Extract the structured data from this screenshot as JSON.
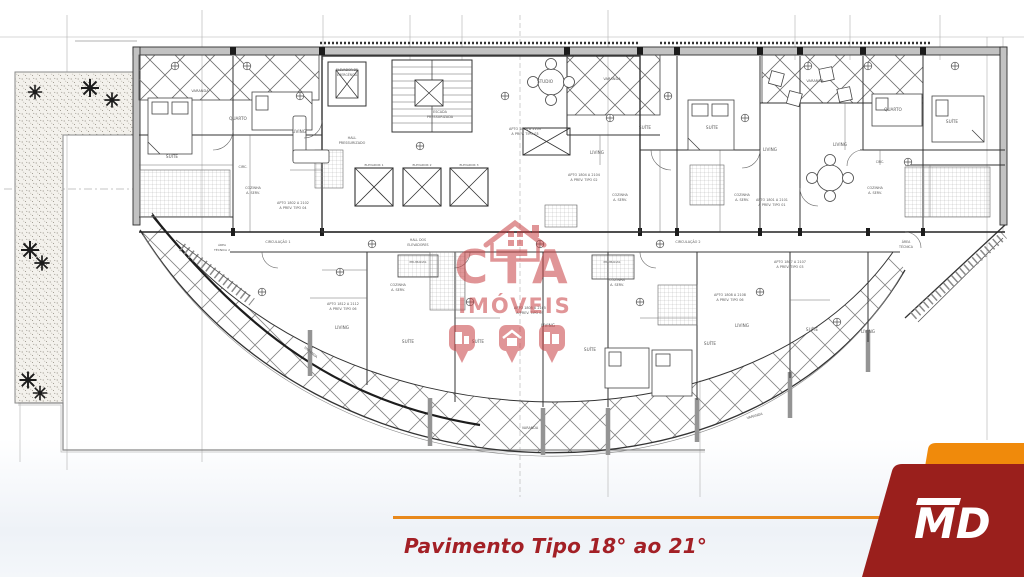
{
  "footer": {
    "caption": "Pavimento Tipo 18° ao 21°",
    "line_color": "#e8891c",
    "text_color": "#a32026"
  },
  "watermark": {
    "line1": "CTA",
    "line2": "IMÓVEIS",
    "color": "#c84043"
  },
  "brand": {
    "logo_text": "MD",
    "orange": "#f08a0b",
    "dark_red": "#9a1f1c"
  },
  "floorplan": {
    "labels": [
      {
        "t": "VARANDA",
        "x": 200,
        "y": 92,
        "s": 3.6
      },
      {
        "t": "SUÍTE",
        "x": 172,
        "y": 158,
        "s": 4.2
      },
      {
        "t": "QUARTO",
        "x": 238,
        "y": 120,
        "s": 4.2
      },
      {
        "t": "LIVING",
        "x": 299,
        "y": 133,
        "s": 4.2
      },
      {
        "t": "CIRC.",
        "x": 243,
        "y": 168,
        "s": 3.4
      },
      {
        "t": "COZINHA",
        "x": 253,
        "y": 189,
        "s": 3.4
      },
      {
        "t": "A. SERV.",
        "x": 253,
        "y": 194,
        "s": 3.4
      },
      {
        "t": "APTO 1802 A 2102",
        "x": 293,
        "y": 204,
        "s": 3.4
      },
      {
        "t": "A PREV. TIPO 04",
        "x": 293,
        "y": 209,
        "s": 3.4
      },
      {
        "t": "ELEVADOR DE",
        "x": 347,
        "y": 71,
        "s": 3.1
      },
      {
        "t": "EMERGÊNCIA",
        "x": 347,
        "y": 76,
        "s": 3.1
      },
      {
        "t": "ESCADA",
        "x": 440,
        "y": 113,
        "s": 3.4
      },
      {
        "t": "PRESSURIZADA",
        "x": 440,
        "y": 118,
        "s": 3.4
      },
      {
        "t": "HALL",
        "x": 352,
        "y": 139,
        "s": 3.4
      },
      {
        "t": "PRESSURIZADO",
        "x": 352,
        "y": 144,
        "s": 3.4
      },
      {
        "t": "ELEVADOR 1",
        "x": 374,
        "y": 166,
        "s": 3
      },
      {
        "t": "ELEVADOR 2",
        "x": 422,
        "y": 166,
        "s": 3
      },
      {
        "t": "ELEVADOR 3",
        "x": 469,
        "y": 166,
        "s": 3
      },
      {
        "t": "STUDIO",
        "x": 545,
        "y": 83,
        "s": 4.2
      },
      {
        "t": "APTO 1803 A 2103",
        "x": 525,
        "y": 130,
        "s": 3.4
      },
      {
        "t": "A PREV. TIPO 03",
        "x": 525,
        "y": 135,
        "s": 3.4
      },
      {
        "t": "VARANDA",
        "x": 612,
        "y": 80,
        "s": 3.6
      },
      {
        "t": "SUÍTE",
        "x": 645,
        "y": 129,
        "s": 4.2
      },
      {
        "t": "SUÍTE",
        "x": 712,
        "y": 129,
        "s": 4.2
      },
      {
        "t": "LIVING",
        "x": 597,
        "y": 154,
        "s": 4.2
      },
      {
        "t": "LIVING",
        "x": 770,
        "y": 151,
        "s": 4.2
      },
      {
        "t": "COZINHA",
        "x": 620,
        "y": 196,
        "s": 3.4
      },
      {
        "t": "A. SERV.",
        "x": 620,
        "y": 201,
        "s": 3.4
      },
      {
        "t": "COZINHA",
        "x": 742,
        "y": 196,
        "s": 3.4
      },
      {
        "t": "A. SERV.",
        "x": 742,
        "y": 201,
        "s": 3.4
      },
      {
        "t": "APTO 1804 A 2104",
        "x": 584,
        "y": 176,
        "s": 3.4
      },
      {
        "t": "A PREV. TIPO 02",
        "x": 584,
        "y": 181,
        "s": 3.4
      },
      {
        "t": "VARANDA",
        "x": 815,
        "y": 82,
        "s": 3.6
      },
      {
        "t": "QUARTO",
        "x": 893,
        "y": 111,
        "s": 4.2
      },
      {
        "t": "SUÍTE",
        "x": 952,
        "y": 123,
        "s": 4.2
      },
      {
        "t": "LIVING",
        "x": 840,
        "y": 146,
        "s": 4.2
      },
      {
        "t": "CIRC.",
        "x": 880,
        "y": 163,
        "s": 3.2
      },
      {
        "t": "COZINHA",
        "x": 875,
        "y": 189,
        "s": 3.4
      },
      {
        "t": "A. SERV.",
        "x": 875,
        "y": 194,
        "s": 3.4
      },
      {
        "t": "APTO 1801 A 2101",
        "x": 772,
        "y": 201,
        "s": 3.4
      },
      {
        "t": "A PREV. TIPO 01",
        "x": 772,
        "y": 206,
        "s": 3.4
      },
      {
        "t": "ÁREA",
        "x": 906,
        "y": 243,
        "s": 3.2
      },
      {
        "t": "TÉCNICA",
        "x": 906,
        "y": 248,
        "s": 3.2
      },
      {
        "t": "ÁREA",
        "x": 222,
        "y": 246,
        "s": 3
      },
      {
        "t": "TÉCNICA 2",
        "x": 222,
        "y": 251,
        "s": 3
      },
      {
        "t": "CIRCULAÇÃO 1",
        "x": 278,
        "y": 243,
        "s": 3.4
      },
      {
        "t": "HALL DOS",
        "x": 418,
        "y": 241,
        "s": 3.2
      },
      {
        "t": "ELEVADORES",
        "x": 418,
        "y": 246,
        "s": 3.2
      },
      {
        "t": "PRUMADAS",
        "x": 418,
        "y": 263,
        "s": 3
      },
      {
        "t": "PRUMADAS",
        "x": 612,
        "y": 263,
        "s": 3
      },
      {
        "t": "CIRCULAÇÃO 2",
        "x": 688,
        "y": 243,
        "s": 3.4
      },
      {
        "t": "APTO 1812 A 2112",
        "x": 343,
        "y": 305,
        "s": 3.4
      },
      {
        "t": "A PREV. TIPO 06",
        "x": 343,
        "y": 310,
        "s": 3.4
      },
      {
        "t": "LIVING",
        "x": 342,
        "y": 329,
        "s": 4.2
      },
      {
        "t": "COZINHA",
        "x": 398,
        "y": 286,
        "s": 3.4
      },
      {
        "t": "A. SERV.",
        "x": 398,
        "y": 291,
        "s": 3.4
      },
      {
        "t": "SUÍTE",
        "x": 408,
        "y": 343,
        "s": 4.2
      },
      {
        "t": "APTO 1805 A 2105",
        "x": 530,
        "y": 309,
        "s": 3.4
      },
      {
        "t": "A PREV. TIPO 05",
        "x": 530,
        "y": 314,
        "s": 3.4
      },
      {
        "t": "LIVING",
        "x": 548,
        "y": 327,
        "s": 4.2
      },
      {
        "t": "SUÍTE",
        "x": 478,
        "y": 343,
        "s": 4.2
      },
      {
        "t": "COZINHA",
        "x": 617,
        "y": 281,
        "s": 3.4
      },
      {
        "t": "A. SERV.",
        "x": 617,
        "y": 286,
        "s": 3.4
      },
      {
        "t": "APTO 1808 A 2108",
        "x": 730,
        "y": 296,
        "s": 3.4
      },
      {
        "t": "A PREV. TIPO 06",
        "x": 730,
        "y": 301,
        "s": 3.4
      },
      {
        "t": "LIVING",
        "x": 742,
        "y": 327,
        "s": 4.2
      },
      {
        "t": "SUÍTE",
        "x": 590,
        "y": 351,
        "s": 4.2
      },
      {
        "t": "SUÍTE",
        "x": 710,
        "y": 345,
        "s": 4.2
      },
      {
        "t": "APTO 1807 A 2107",
        "x": 790,
        "y": 263,
        "s": 3.4
      },
      {
        "t": "A PREV. TIPO 03",
        "x": 790,
        "y": 268,
        "s": 3.4
      },
      {
        "t": "SUÍTE",
        "x": 812,
        "y": 331,
        "s": 4.2
      },
      {
        "t": "LIVING",
        "x": 868,
        "y": 333,
        "s": 4.2
      },
      {
        "t": "VARANDA",
        "x": 310,
        "y": 353,
        "s": 3.4,
        "r": 40
      },
      {
        "t": "VARANDA",
        "x": 530,
        "y": 429,
        "s": 3.4
      },
      {
        "t": "VARANDA",
        "x": 755,
        "y": 417,
        "s": 3.4,
        "r": -16
      }
    ]
  }
}
